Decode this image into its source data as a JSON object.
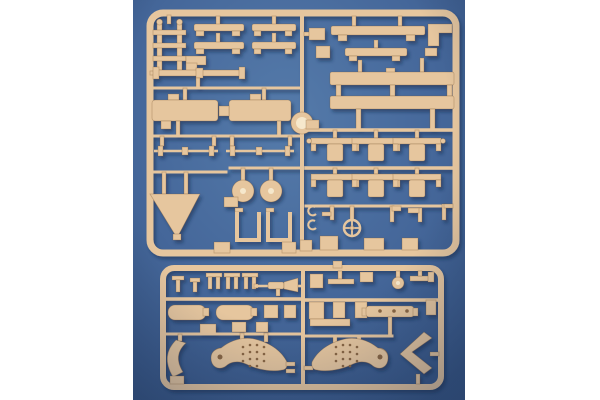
{
  "scene": {
    "type": "photograph",
    "subject": "Injection-molded plastic model kit sprues (tan styrene parts frames) photographed on a blue surface",
    "composition": "vertical photo centered with white margins left and right; large sprue on top, small sprue below",
    "text_visible": "none",
    "sprues": [
      {
        "name": "large upper sprue",
        "frame": "rounded rectangle with central vertical runner and round molding disc",
        "parts": [
          "ladder bracket",
          "leaf-spring bars (two pairs)",
          "step bracket",
          "axle with end caps",
          "gun cradle blocks with coupling",
          "two thin axles with collars",
          "triangular trail spade",
          "two round wheel discs",
          "two U-shaped brackets",
          "stepped top bars",
          "corner bracket",
          "two long hull bars",
          "six T-shaped suspension brackets in two rows",
          "steering wheel",
          "small crank levers and hooks",
          "mounting foot blocks"
        ]
      },
      {
        "name": "small lower sprue",
        "frame": "rounded rectangle with central vertical runner",
        "parts": [
          "pin fittings",
          "three fork fittings",
          "machine gun",
          "two cylindrical tanks",
          "small boxes",
          "curved fender",
          "two curved gun-shield plates with rivet rows and locating holes",
          "tow brackets",
          "perforated axle beam",
          "small wheel",
          "side mount",
          "angled chevron bracket"
        ]
      }
    ]
  },
  "colors": {
    "page_bg": "#ffffff",
    "photo_blue_center": "#557baa",
    "photo_blue_mid": "#45679a",
    "photo_blue_edge": "#34527f",
    "vignette": "#16284a",
    "sprue_tan": "#e6c69e",
    "sprue_tan_light": "#f6e8cc",
    "detail_dark": "#8a6642",
    "shadow": "#16284a"
  }
}
